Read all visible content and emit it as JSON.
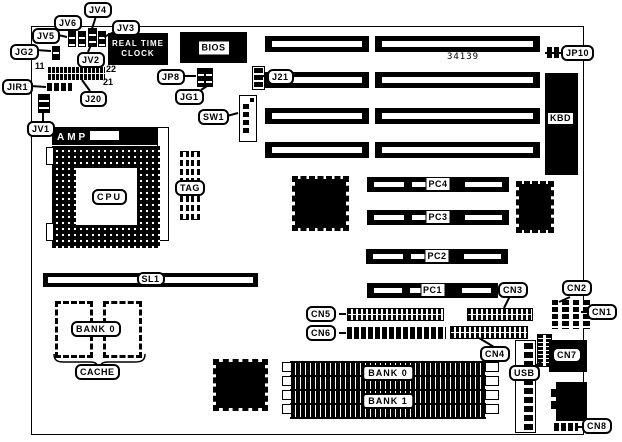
{
  "board": {
    "part_number": "34139"
  },
  "labels": {
    "jv1": "JV1",
    "jv2": "JV2",
    "jv3": "JV3",
    "jv4": "JV4",
    "jv5": "JV5",
    "jv6": "JV6",
    "jg1": "JG1",
    "jg2": "JG2",
    "jir1": "JIR1",
    "j20": "J20",
    "j21": "J21",
    "jp8": "JP8",
    "jp10": "JP10",
    "sw1": "SW1",
    "j20_pin11": "11",
    "j20_pin22": "22",
    "j20_pin21": "21",
    "rtc_line1": "REAL TIME",
    "rtc_line2": "CLOCK",
    "bios": "BIOS",
    "kbd": "KBD",
    "amp": "AMP",
    "cpu": "CPU",
    "tag": "TAG",
    "sl1": "SL1",
    "cache_bank": "BANK 0",
    "cache": "CACHE",
    "pc1": "PC1",
    "pc2": "PC2",
    "pc3": "PC3",
    "pc4": "PC4",
    "cn1": "CN1",
    "cn2": "CN2",
    "cn3": "CN3",
    "cn4": "CN4",
    "cn5": "CN5",
    "cn6": "CN6",
    "cn7": "CN7",
    "cn8": "CN8",
    "usb": "USB",
    "simm_bank0": "BANK 0",
    "simm_bank1": "BANK 1"
  }
}
